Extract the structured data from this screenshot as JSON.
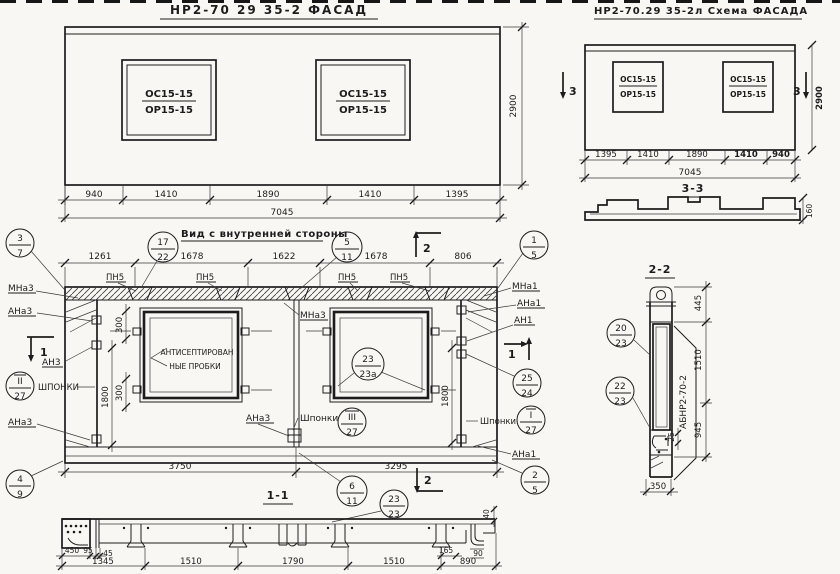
{
  "facadeLeft": {
    "title": "НР2-70 29 35-2  ФАСАД",
    "win": {
      "top": "ОС15-15",
      "bot": "ОР15-15"
    },
    "dims": {
      "d1": "940",
      "d2": "1410",
      "d3": "1890",
      "d4": "1410",
      "d5": "1395",
      "total": "7045",
      "height": "2900"
    }
  },
  "facadeRight": {
    "title": "НР2-70.29 35-2л Схема ФАСАДА",
    "win": {
      "top": "ОС15-15",
      "bot": "ОР15-15"
    },
    "dims": {
      "d1": "1395",
      "d2": "1410",
      "d3": "1890",
      "d4": "1410",
      "d5": "940",
      "total": "7045",
      "height": "2900"
    },
    "marker": "3"
  },
  "section33": {
    "title": "3-3",
    "thickness": "160"
  },
  "innerView": {
    "title": "Вид с внутренней стороны",
    "dimsTop": {
      "d1": "1261",
      "d2": "1678",
      "d3": "1622",
      "d4": "1678",
      "d5": "806"
    },
    "dimsBottom": {
      "left": "3750",
      "right": "3295"
    },
    "dimsVert": {
      "v300a": "300",
      "v300b": "300",
      "v1800L": "1800",
      "v1800R": "1800"
    },
    "pn5": "ПН5",
    "plugLine1": "АНТИСЕПТИРОВАН",
    "plugLine2": "НЫЕ ПРОБКИ",
    "labels": {
      "mna3a": "МНа3",
      "ana3a": "АНа3",
      "an3": "АН3",
      "shponki1": "ШПОНКИ",
      "ana3b": "АНа3",
      "mna3c": "МНа3",
      "ana3c": "АНа3",
      "shponki2": "Шпонки",
      "mna1": "МНа1",
      "ana1a": "АНа1",
      "an1": "АН1",
      "shponki3": "Шпонки",
      "ana1b": "АНа1"
    },
    "balloons": {
      "b37": {
        "t": "3",
        "b": "7"
      },
      "b1722": {
        "t": "17",
        "b": "22"
      },
      "b511": {
        "t": "5",
        "b": "11"
      },
      "b15": {
        "t": "1",
        "b": "5"
      },
      "b227": {
        "t": "II",
        "b": "27"
      },
      "b327": {
        "t": "III",
        "b": "27"
      },
      "b127": {
        "t": "I",
        "b": "27"
      },
      "b2323a": {
        "t": "23",
        "b": "23а"
      },
      "b2524": {
        "t": "25",
        "b": "24"
      },
      "b49": {
        "t": "4",
        "b": "9"
      },
      "b611": {
        "t": "6",
        "b": "11"
      },
      "b25": {
        "t": "2",
        "b": "5"
      }
    },
    "marks": {
      "m2top": "2",
      "m1left": "1",
      "m1right": "1",
      "m2bottom": "2"
    }
  },
  "section11": {
    "title": "1-1",
    "balloon": {
      "t": "23",
      "b": "23"
    },
    "dims": {
      "d450": "450",
      "d95": "95",
      "d45": "45",
      "d1345": "1345",
      "d1510a": "1510",
      "d1790": "1790",
      "d1510b": "1510",
      "d890": "890",
      "d165": "165",
      "d90": "90",
      "d40": "40"
    }
  },
  "section22": {
    "title": "2-2",
    "partLabel": "АБНР2-70-2",
    "balloons": {
      "b2023": {
        "t": "20",
        "b": "23"
      },
      "b2223": {
        "t": "22",
        "b": "23"
      }
    },
    "dims": {
      "d445": "445",
      "d1510": "1510",
      "d25": "25",
      "d945": "945",
      "d350": "350"
    }
  }
}
